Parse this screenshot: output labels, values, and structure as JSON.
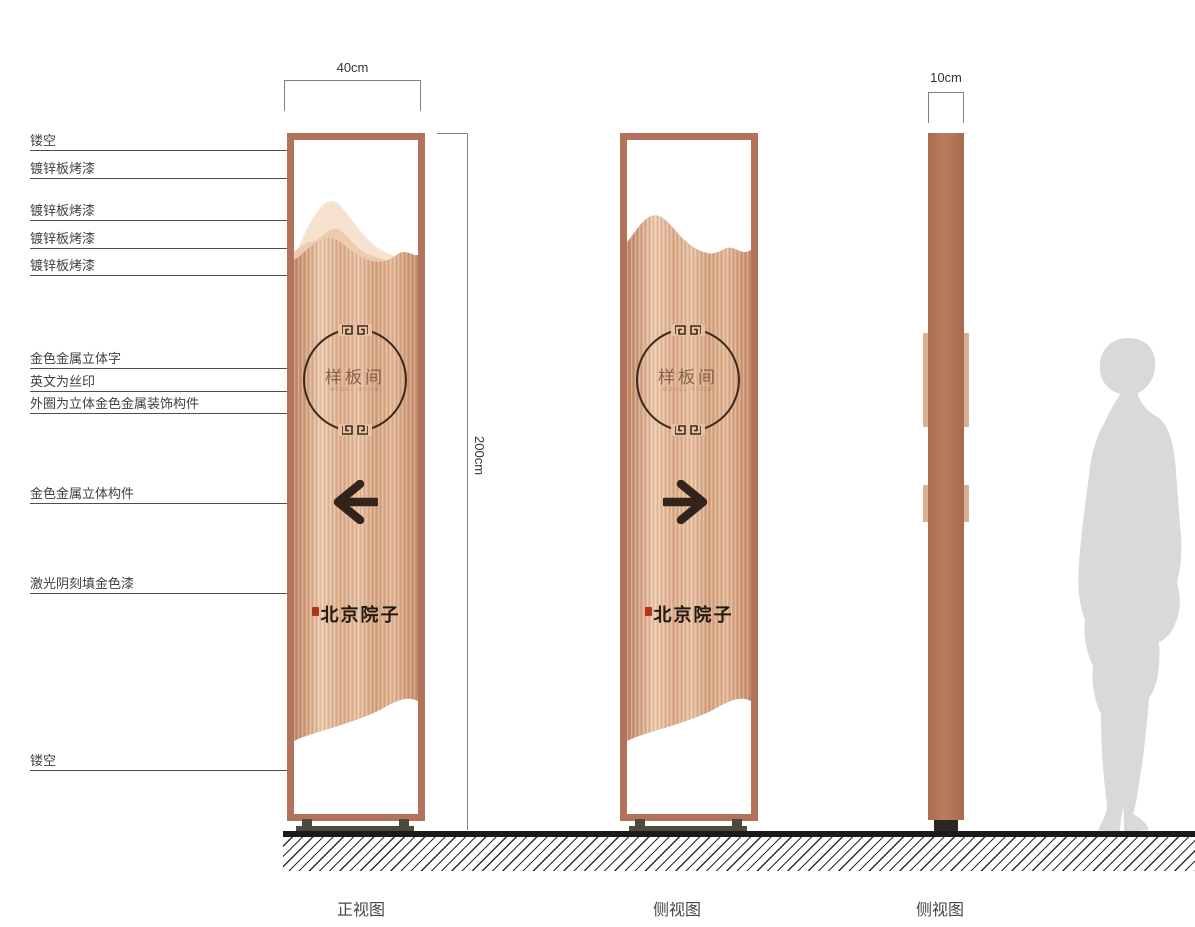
{
  "annotations": [
    {
      "label": "镂空"
    },
    {
      "label": "镀锌板烤漆"
    },
    {
      "label": "镀锌板烤漆"
    },
    {
      "label": "镀锌板烤漆"
    },
    {
      "label": "镀锌板烤漆"
    },
    {
      "label": "金色金属立体字"
    },
    {
      "label": "英文为丝印"
    },
    {
      "label": "外圈为立体金色金属装饰构件"
    },
    {
      "label": "金色金属立体构件"
    },
    {
      "label": "激光阴刻填金色漆"
    },
    {
      "label": "镂空"
    }
  ],
  "dimensions": {
    "front_width": "40cm",
    "height": "200cm",
    "side_depth": "10cm"
  },
  "views": {
    "front": {
      "label": "正视图",
      "circle_text": "样板间",
      "circle_subtext": "MODEL ROOM",
      "brand_text": "北京院子",
      "arrow": "left"
    },
    "side": {
      "label": "侧视图",
      "circle_text": "样板间",
      "circle_subtext": "MODEL ROOM",
      "brand_text": "北京院子",
      "arrow": "right"
    },
    "profile": {
      "label": "侧视图"
    }
  },
  "colors": {
    "copper_frame": "#b2735a",
    "panel_light": "#ecc9ab",
    "panel_dark": "#c08767",
    "mountain_back": "#f7e2cf",
    "mountain_mid": "#eecbb0",
    "circle_stroke": "#3a2a1e",
    "arrow": "#33231a",
    "seal_red": "#b5321f",
    "base": "#4b4a3b",
    "ground": "#1b1b1b",
    "profile_tab": "#d9b190",
    "silhouette": "#d9d9d9"
  }
}
